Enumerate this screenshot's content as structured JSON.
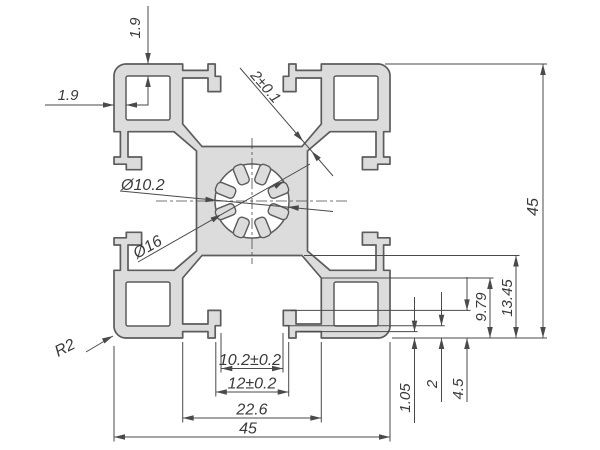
{
  "drawing": {
    "dims": {
      "wall_top": "1.9",
      "wall_left": "1.9",
      "web_thickness": "2±0.1",
      "bore_small": "Ø10.2",
      "bore_large": "Ø16",
      "corner_radius": "R2",
      "slot_throat": "10.2±0.2",
      "slot_mouth": "12±0.2",
      "cavity_width": "22.6",
      "profile_width": "45",
      "profile_height": "45",
      "rib_depth": "1.05",
      "hook_step": "2",
      "lip_depth": "4.5",
      "cavity_shoulder": "9.79",
      "cavity_depth": "13.45"
    },
    "colors": {
      "profile_fill": "#dcdcdc",
      "outline": "#5c5c5c",
      "dimension_line": "#4a4a4a",
      "text": "#3a3a3a"
    }
  }
}
